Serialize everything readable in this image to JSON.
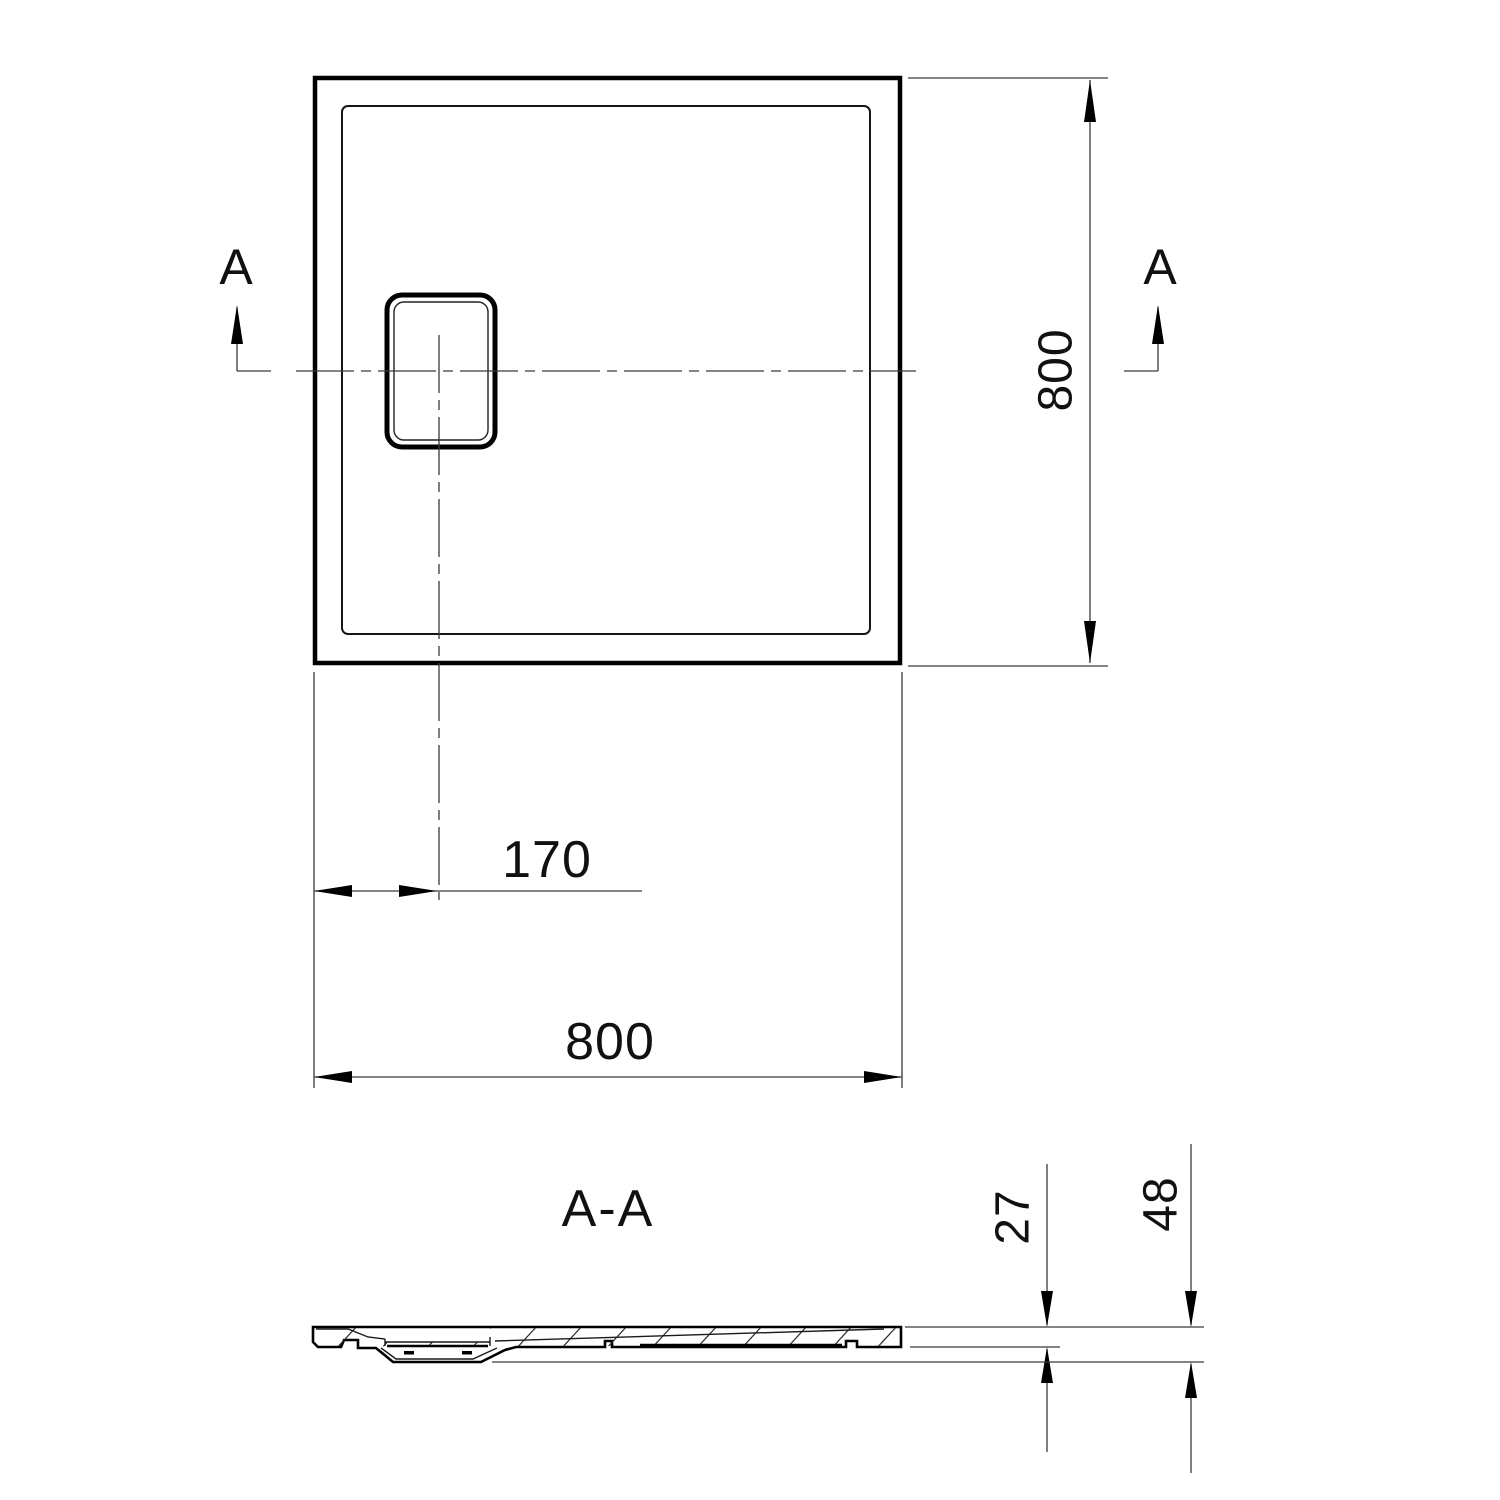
{
  "drawing": {
    "section_label": "A-A",
    "section_marker_left": "A",
    "section_marker_right": "A",
    "dim_depth_label": "800",
    "dim_width_label": "800",
    "dim_drain_offset_label": "170",
    "dim_edge_thickness_label": "27",
    "dim_total_height_label": "48",
    "colors": {
      "line": "#000000",
      "thin_line": "#3a3a3a",
      "text": "#111111",
      "background": "#ffffff"
    }
  }
}
